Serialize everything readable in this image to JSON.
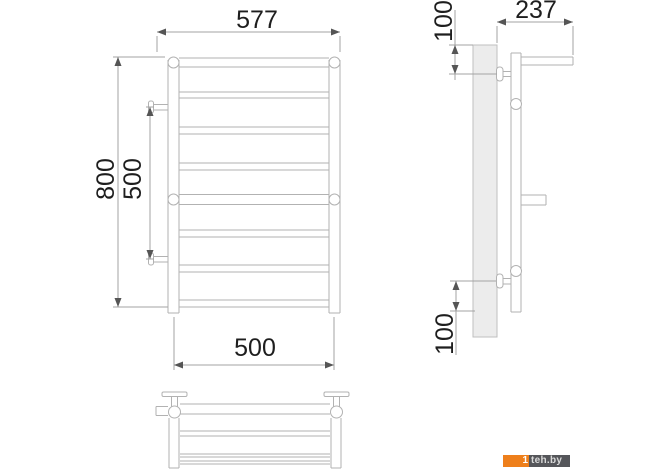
{
  "front_view": {
    "width_label": "577",
    "height_label": "800",
    "mount_spacing_label": "500",
    "bottom_width_label": "500"
  },
  "side_view": {
    "depth_label": "237",
    "top_offset_label": "100",
    "bottom_offset_label": "100"
  },
  "watermark": {
    "prefix": "1",
    "site": "teh.by",
    "orange_color": "#ee7f1b",
    "dark_color": "#55565a"
  }
}
